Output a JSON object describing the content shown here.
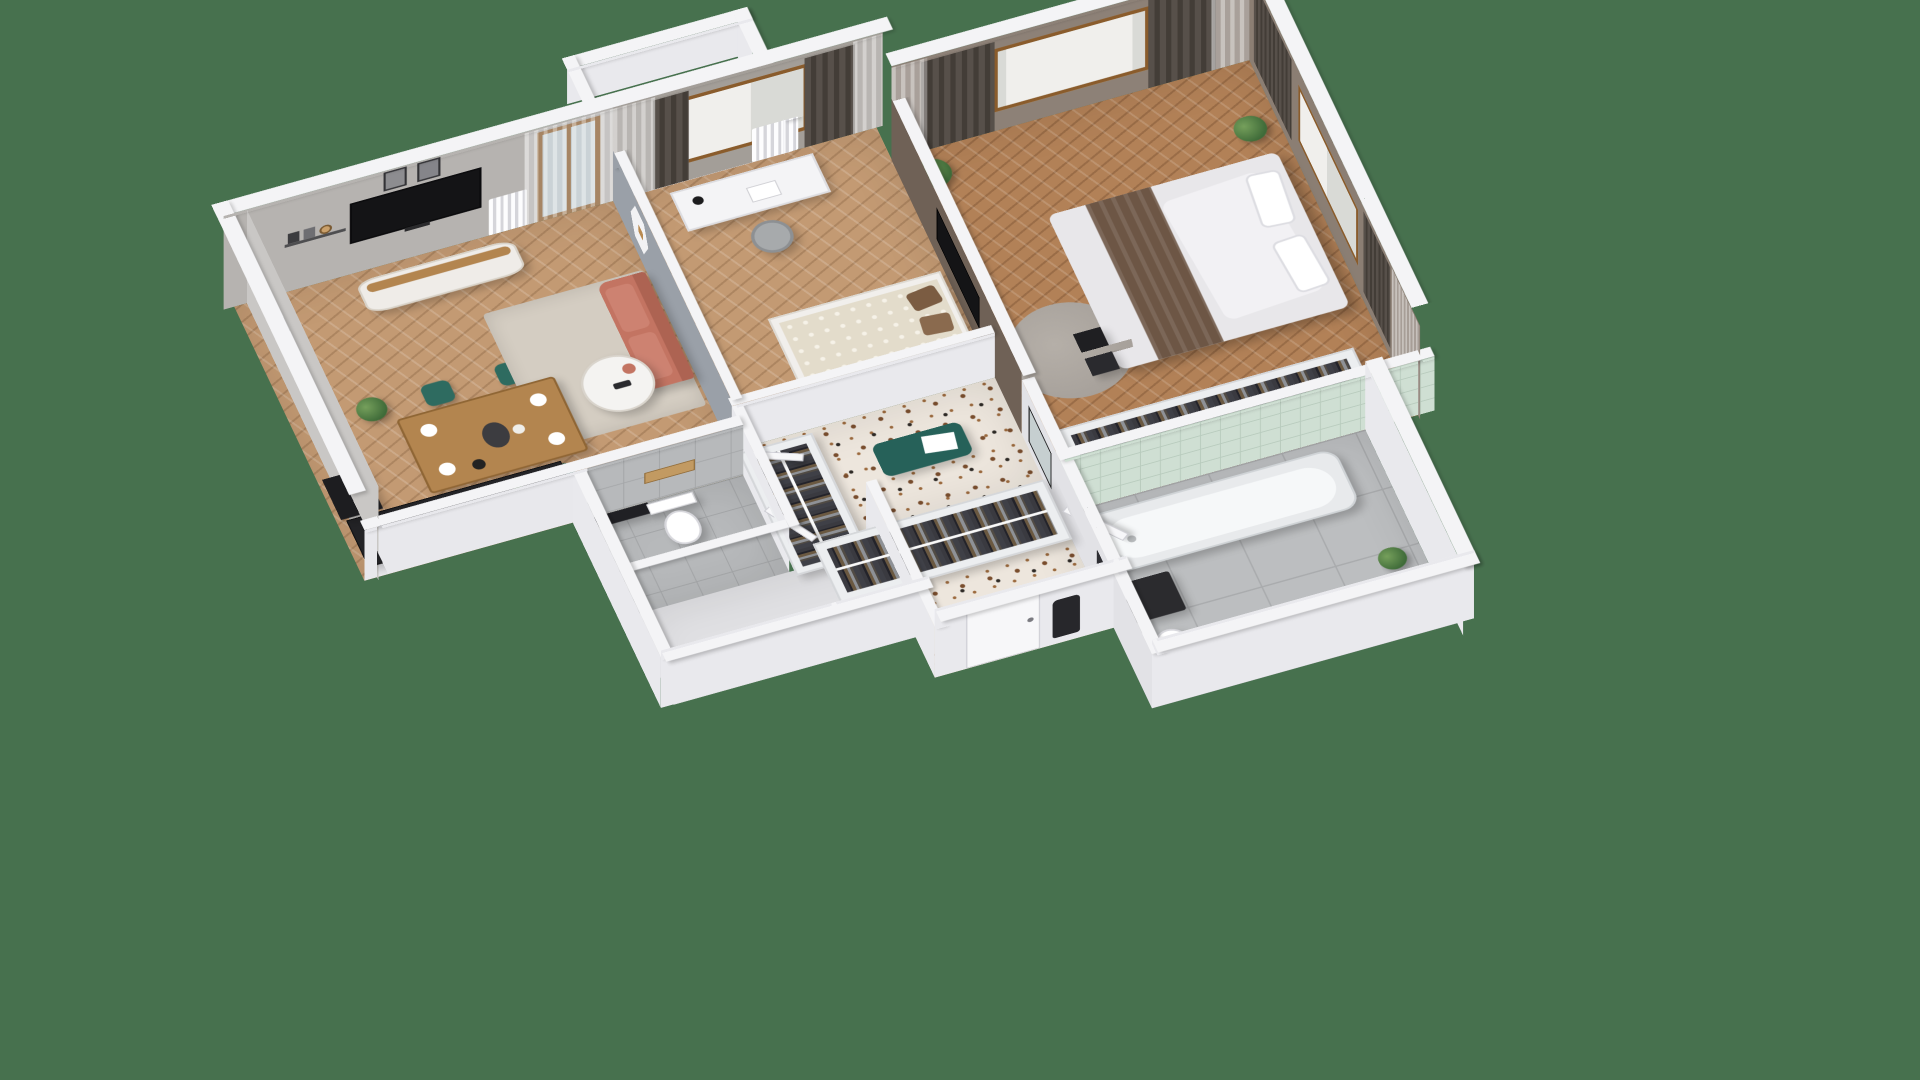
{
  "scene": {
    "type": "isometric-3d-floor-plan-render",
    "view": "cutaway dollhouse view of a one-bedroom apartment, rotated roughly 20 degrees, seen from above",
    "background_color": "#47714E",
    "visible_text": "none"
  },
  "palette": {
    "bg": "#47714E",
    "wallTop": "#f4f4f6",
    "wallWhite": "#e9e9ed",
    "wallGray": "#b6b3b0",
    "wallGrayLight": "#c9c7c5",
    "wallBlue": "#9aa0a8",
    "wallBrown": "#6f6156",
    "wallTan": "#8d8177",
    "floorWoodA": "#c39a73",
    "floorBedA": "#b28157",
    "terrazzo": "#ede6dd",
    "tileGray": "#bcbec0",
    "tileMint": "#cfdfd3",
    "counter": "#232326",
    "teal": "#2e6b60",
    "coral": "#c37462",
    "woodMid": "#b3854f",
    "woodFrame": "#8a5c2c",
    "tvBlack": "#141416",
    "duvet": "#e8e7ea",
    "throw": "#6d5645",
    "rugBeige": "#d4cdc2",
    "rugGray": "#a6a09a",
    "doorWhite": "#f7f7f9",
    "plant": "#4c7a44"
  },
  "rooms": [
    {
      "id": "living-room",
      "label": "Living room with kitchenette",
      "floor": "oak herringbone",
      "furniture": [
        "black kitchen counter with hob, pan and moka pot",
        "dining table set for four",
        "four teal chairs",
        "TV on white-and-wood sideboard",
        "two framed prints",
        "picture ledge with small frames",
        "coral sofa",
        "round white coffee table",
        "beige rug",
        "potted plant",
        "balcony door with sheer curtain",
        "radiator"
      ]
    },
    {
      "id": "balcony",
      "label": "Balcony",
      "furniture": []
    },
    {
      "id": "study",
      "label": "Study / guest room",
      "floor": "oak herringbone",
      "furniture": [
        "white desk with drawers",
        "desk lamp and open book",
        "grey chair",
        "hexagonal wall shelf",
        "daybed with patterned blanket and brown pillows",
        "window with brown and sheer curtains",
        "radiator"
      ]
    },
    {
      "id": "bedroom",
      "label": "Bedroom",
      "floor": "oak herringbone",
      "furniture": [
        "double bed with white duvet and brown throw",
        "white pillows",
        "black bedside units",
        "wall-mounted TV on brown accent wall",
        "open wardrobe full of clothes",
        "round grey rug",
        "two potted plants",
        "windows with dark and sheer curtains",
        "black floor lamp"
      ]
    },
    {
      "id": "hallway",
      "label": "Hallway",
      "floor": "terrazzo",
      "furniture": [
        "teal upholstered bench with white tray",
        "wall mirror",
        "two open wardrobes with hanging clothes"
      ]
    },
    {
      "id": "wc",
      "label": "WC",
      "floor": "grey tile",
      "furniture": [
        "toilet",
        "wooden shelf",
        "dark niche"
      ]
    },
    {
      "id": "storage",
      "label": "Storage room",
      "floor": "plain",
      "furniture": []
    },
    {
      "id": "bathroom",
      "label": "Bathroom",
      "floor": "large grey tile",
      "furniture": [
        "bathtub against mint tiled wall",
        "wooden vanity with white basin",
        "toilet",
        "dark floor mat",
        "dark towel",
        "small plant"
      ]
    },
    {
      "id": "entry",
      "label": "Entrance",
      "furniture": [
        "entry door",
        "dark coat on hook"
      ]
    }
  ]
}
